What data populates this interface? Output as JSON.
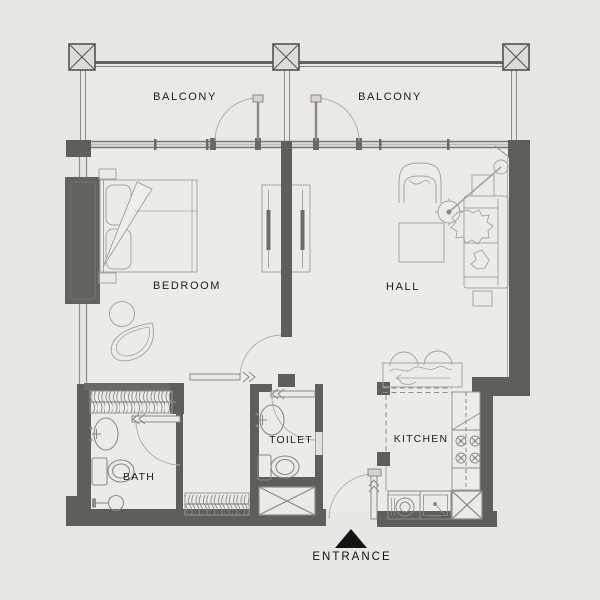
{
  "plan": {
    "title": "apartment-floor-plan",
    "rooms": [
      {
        "id": "balcony-left",
        "label": "BALCONY"
      },
      {
        "id": "balcony-right",
        "label": "BALCONY"
      },
      {
        "id": "bedroom",
        "label": "BEDROOM"
      },
      {
        "id": "hall",
        "label": "HALL"
      },
      {
        "id": "bath",
        "label": "BATH"
      },
      {
        "id": "toilet",
        "label": "TOILET"
      },
      {
        "id": "kitchen",
        "label": "KITCHEN"
      }
    ],
    "entrance": {
      "label": "ENTRANCE"
    },
    "colors": {
      "background": "#e9e7e3",
      "interior": "#edebe7",
      "wall_dark": "#605e5a",
      "line_medium": "#8d8a85",
      "line_light": "#a8a5a0",
      "text": "#1d1d1d"
    }
  }
}
